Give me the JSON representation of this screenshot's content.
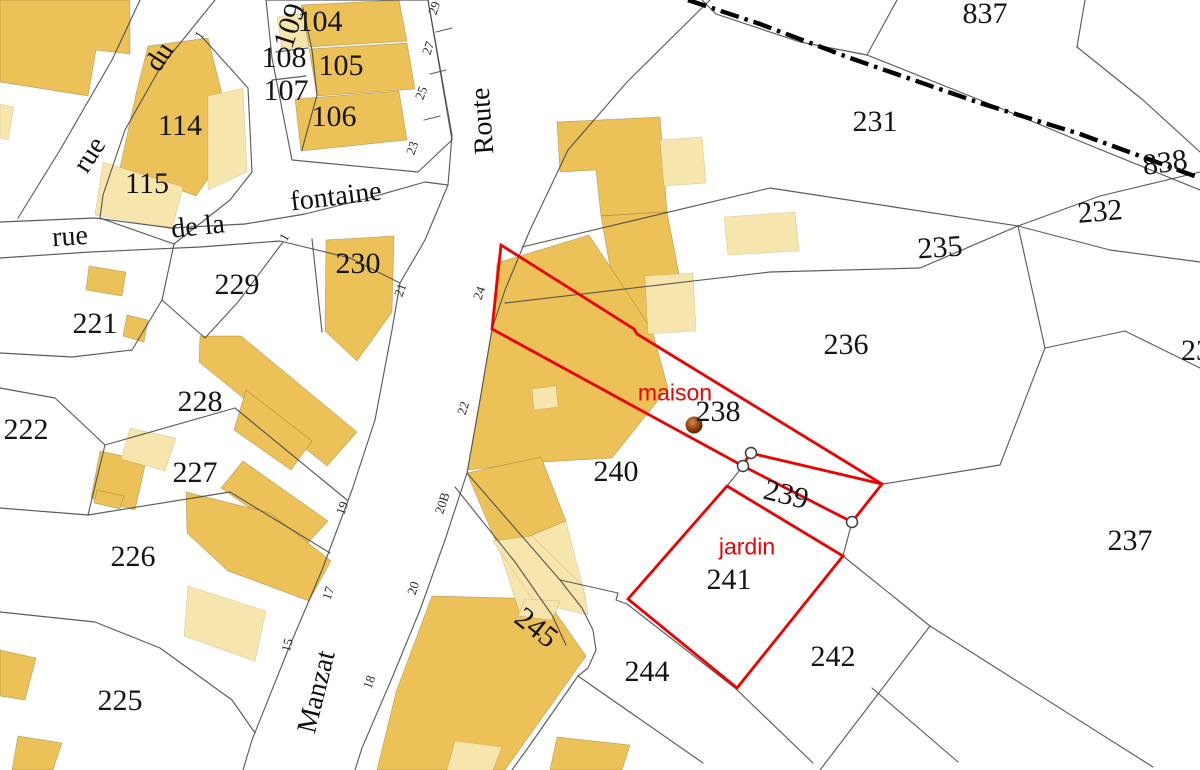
{
  "map": {
    "kind": "cadastral-parcel-map",
    "colors": {
      "background": "#ffffff",
      "building": "#ecc258",
      "building_light": "#f7e5ae",
      "parcel_line": "#4a4a4a",
      "highlight_red": "#ee0000",
      "label_black": "#141414",
      "point_brown": "#8a3c10"
    },
    "selected_parcels": [
      "238",
      "239",
      "241"
    ],
    "annotations": [
      {
        "text": "maison",
        "x": 675,
        "y": 393
      },
      {
        "text": "jardin",
        "x": 747,
        "y": 547
      }
    ],
    "labels": [
      {
        "text": "104",
        "x": 320,
        "y": 22,
        "cls": "p",
        "rot": 0
      },
      {
        "text": "105",
        "x": 341,
        "y": 66,
        "cls": "p",
        "rot": 0
      },
      {
        "text": "106",
        "x": 334,
        "y": 117,
        "cls": "p",
        "rot": 0
      },
      {
        "text": "107",
        "x": 286,
        "y": 91,
        "cls": "p",
        "rot": 0
      },
      {
        "text": "108",
        "x": 284,
        "y": 58,
        "cls": "p",
        "rot": 0
      },
      {
        "text": "109",
        "x": 290,
        "y": 26,
        "cls": "p",
        "rot": -72
      },
      {
        "text": "114",
        "x": 180,
        "y": 126,
        "cls": "p",
        "rot": 0
      },
      {
        "text": "115",
        "x": 147,
        "y": 184,
        "cls": "p",
        "rot": 0
      },
      {
        "text": "221",
        "x": 95,
        "y": 324,
        "cls": "p",
        "rot": 0
      },
      {
        "text": "222",
        "x": 26,
        "y": 430,
        "cls": "p",
        "rot": 0
      },
      {
        "text": "225",
        "x": 120,
        "y": 701,
        "cls": "p",
        "rot": 0
      },
      {
        "text": "226",
        "x": 133,
        "y": 557,
        "cls": "p",
        "rot": 0
      },
      {
        "text": "227",
        "x": 195,
        "y": 473,
        "cls": "p",
        "rot": 0
      },
      {
        "text": "228",
        "x": 200,
        "y": 402,
        "cls": "p",
        "rot": 0
      },
      {
        "text": "229",
        "x": 237,
        "y": 285,
        "cls": "p",
        "rot": 0
      },
      {
        "text": "230",
        "x": 358,
        "y": 264,
        "cls": "p",
        "rot": 0
      },
      {
        "text": "231",
        "x": 875,
        "y": 122,
        "cls": "p",
        "rot": 0
      },
      {
        "text": "232",
        "x": 1100,
        "y": 212,
        "cls": "p",
        "rot": -5
      },
      {
        "text": "235",
        "x": 940,
        "y": 248,
        "cls": "p",
        "rot": -4
      },
      {
        "text": "236",
        "x": 846,
        "y": 345,
        "cls": "p",
        "rot": 0
      },
      {
        "text": "237",
        "x": 1130,
        "y": 541,
        "cls": "p",
        "rot": 0
      },
      {
        "text": "238",
        "x": 718,
        "y": 412,
        "cls": "p",
        "rot": 0
      },
      {
        "text": "239",
        "x": 786,
        "y": 495,
        "cls": "p",
        "rot": 14
      },
      {
        "text": "240",
        "x": 616,
        "y": 472,
        "cls": "p",
        "rot": 0
      },
      {
        "text": "241",
        "x": 729,
        "y": 580,
        "cls": "p",
        "rot": 0
      },
      {
        "text": "242",
        "x": 833,
        "y": 657,
        "cls": "p",
        "rot": 0
      },
      {
        "text": "244",
        "x": 647,
        "y": 672,
        "cls": "p",
        "rot": 0
      },
      {
        "text": "245",
        "x": 536,
        "y": 628,
        "cls": "p",
        "rot": 38
      },
      {
        "text": "837",
        "x": 985,
        "y": 14,
        "cls": "p",
        "rot": 0
      },
      {
        "text": "838",
        "x": 1165,
        "y": 163,
        "cls": "p",
        "rot": -8
      },
      {
        "text": "23",
        "x": 1196,
        "y": 351,
        "cls": "p",
        "rot": 0
      },
      {
        "text": "29",
        "x": 434,
        "y": 8,
        "cls": "h",
        "rot": -70
      },
      {
        "text": "27",
        "x": 428,
        "y": 48,
        "cls": "h",
        "rot": -70
      },
      {
        "text": "25",
        "x": 421,
        "y": 93,
        "cls": "h",
        "rot": -70
      },
      {
        "text": "23",
        "x": 412,
        "y": 148,
        "cls": "h",
        "rot": -70
      },
      {
        "text": "24",
        "x": 479,
        "y": 293,
        "cls": "h",
        "rot": -70
      },
      {
        "text": "22",
        "x": 463,
        "y": 408,
        "cls": "h",
        "rot": -72
      },
      {
        "text": "21",
        "x": 400,
        "y": 290,
        "cls": "h",
        "rot": -70
      },
      {
        "text": "20B",
        "x": 442,
        "y": 503,
        "cls": "h",
        "rot": -72
      },
      {
        "text": "20",
        "x": 413,
        "y": 588,
        "cls": "h",
        "rot": -72
      },
      {
        "text": "19",
        "x": 342,
        "y": 508,
        "cls": "h",
        "rot": -70
      },
      {
        "text": "18",
        "x": 369,
        "y": 682,
        "cls": "h",
        "rot": -70
      },
      {
        "text": "17",
        "x": 328,
        "y": 593,
        "cls": "h",
        "rot": -72
      },
      {
        "text": "15",
        "x": 287,
        "y": 645,
        "cls": "h",
        "rot": -75
      },
      {
        "text": "1",
        "x": 199,
        "y": 35,
        "cls": "h",
        "rot": -55
      },
      {
        "text": "1",
        "x": 284,
        "y": 237,
        "cls": "h",
        "rot": -60
      },
      {
        "text": "rue",
        "x": 90,
        "y": 155,
        "cls": "s",
        "rot": -57
      },
      {
        "text": "du",
        "x": 160,
        "y": 57,
        "cls": "s",
        "rot": -57
      },
      {
        "text": "rue",
        "x": 70,
        "y": 237,
        "cls": "s",
        "rot": -4
      },
      {
        "text": "de la",
        "x": 198,
        "y": 227,
        "cls": "s",
        "rot": -6
      },
      {
        "text": "fontaine",
        "x": 336,
        "y": 197,
        "cls": "s",
        "rot": -7
      },
      {
        "text": "Route",
        "x": 483,
        "y": 121,
        "cls": "s",
        "rot": -94
      },
      {
        "text": "Manzat",
        "x": 317,
        "y": 692,
        "cls": "s",
        "rot": -76
      },
      {
        "text": "maison",
        "x": 675,
        "y": 393,
        "cls": "r",
        "rot": 0
      },
      {
        "text": "jardin",
        "x": 747,
        "y": 547,
        "cls": "r",
        "rot": 0
      }
    ]
  }
}
